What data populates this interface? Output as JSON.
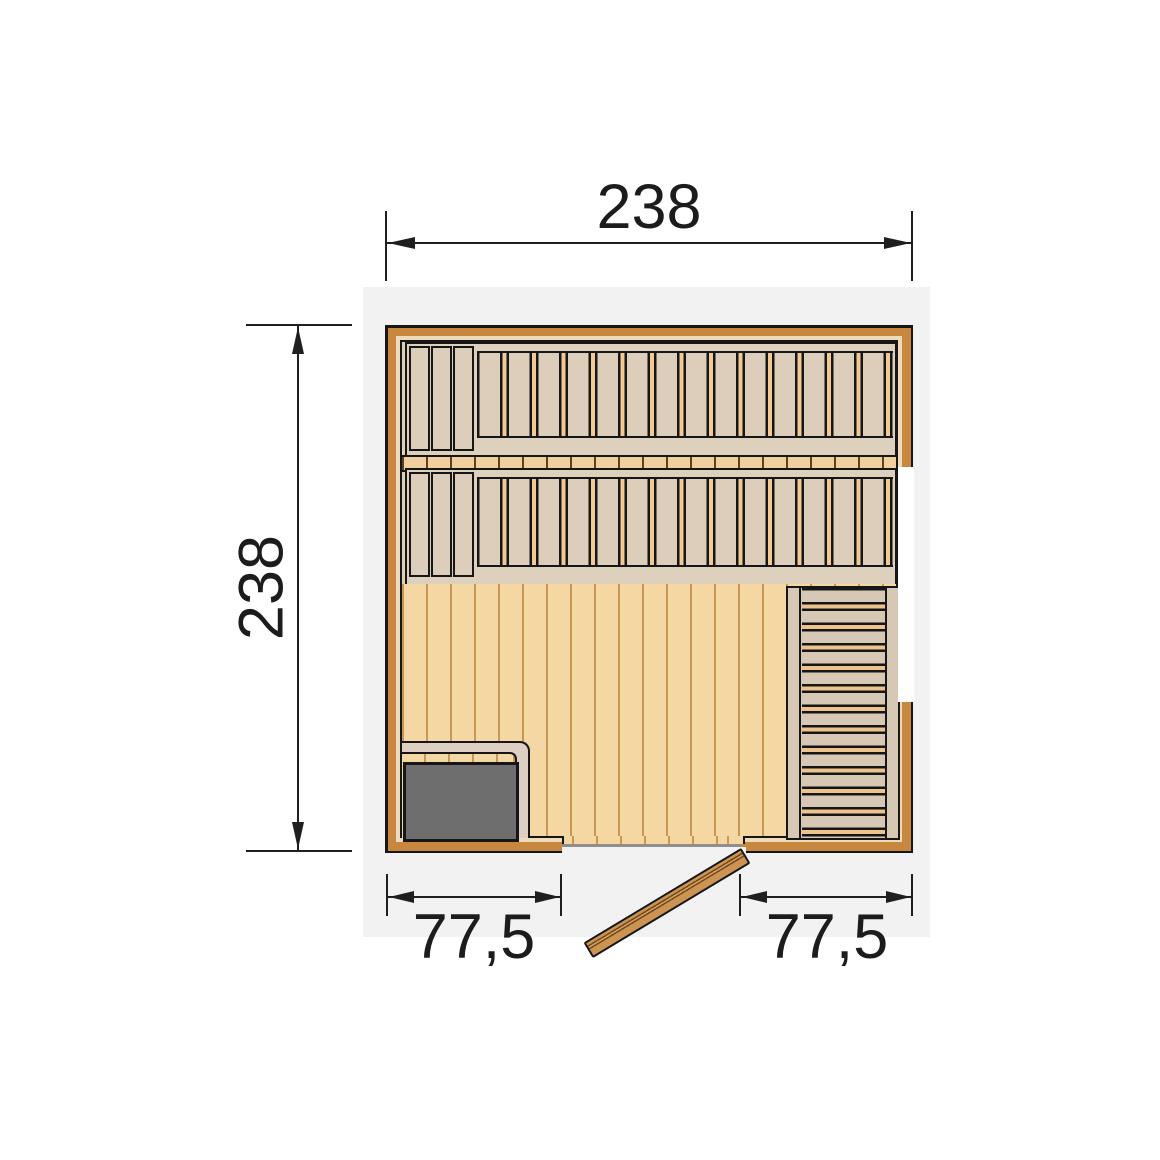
{
  "document": {
    "type": "sauna-floor-plan",
    "view": "top-view technical drawing"
  },
  "dimensions": {
    "top_width": "238",
    "left_depth": "238",
    "door_left_offset": "77,5",
    "door_right_offset": "77,5"
  },
  "colors": {
    "page_background": "#ffffff",
    "plan_area_background": "#f2f2f3",
    "wall_frame": "#c8873e",
    "wall_lining": "#eedbbc",
    "bench_wood": "#dcceba",
    "bench_slat_gap": "#f2c993",
    "floor_wood": "#f5d7a3",
    "floor_joint": "#c89655",
    "step_tread_gap": "#eec28d",
    "heater_fill": "#6e6e6e",
    "outline": "#161616",
    "dimension_color": "#1f1f1f"
  }
}
